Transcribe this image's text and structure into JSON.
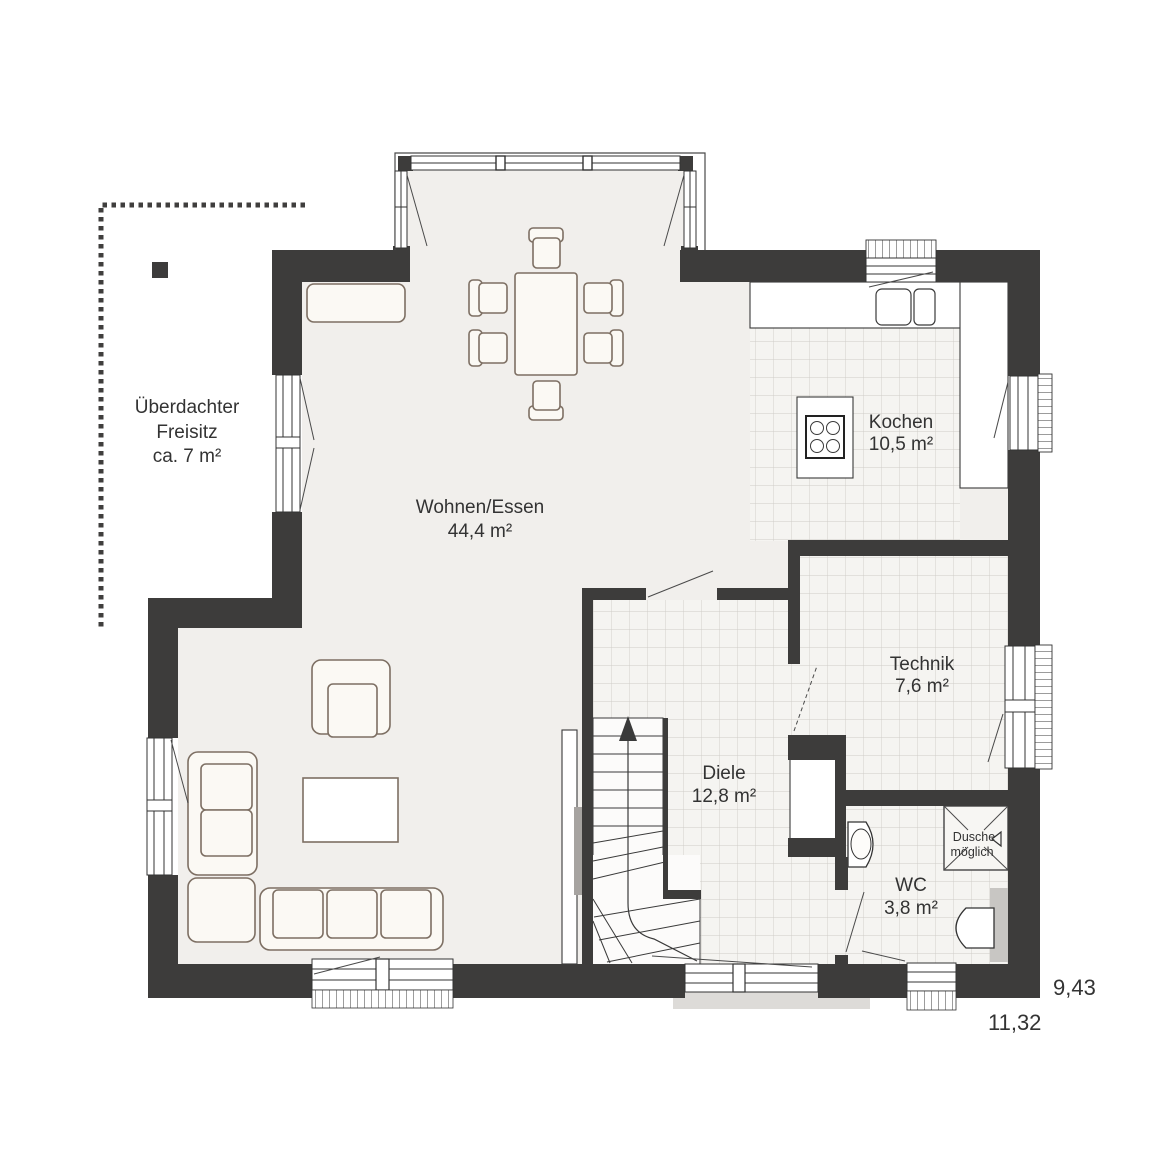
{
  "title": "Erdgeschoss Grundriss",
  "rooms": {
    "freisitz": {
      "line1": "Überdachter",
      "line2": "Freisitz",
      "line3": "ca. 7 m²"
    },
    "wohnen": {
      "name": "Wohnen/Essen",
      "area": "44,4 m²"
    },
    "kochen": {
      "name": "Kochen",
      "area": "10,5 m²"
    },
    "technik": {
      "name": "Technik",
      "area": "7,6 m²"
    },
    "diele": {
      "name": "Diele",
      "area": "12,8 m²"
    },
    "wc": {
      "name": "WC",
      "area": "3,8 m²"
    }
  },
  "shower_note": {
    "line1": "Dusche",
    "line2": "möglich"
  },
  "dimensions": {
    "total_width": "11,32",
    "total_depth": "9,43"
  },
  "colors": {
    "wall": "#3d3c3b",
    "floor": "#f1efec",
    "tilebg": "#f5f4f1",
    "tileline": "#cfccc8",
    "furn": "#7d6f63",
    "furnfill": "#fbf9f4",
    "ink": "#333333",
    "porch": "#dddbd8"
  }
}
